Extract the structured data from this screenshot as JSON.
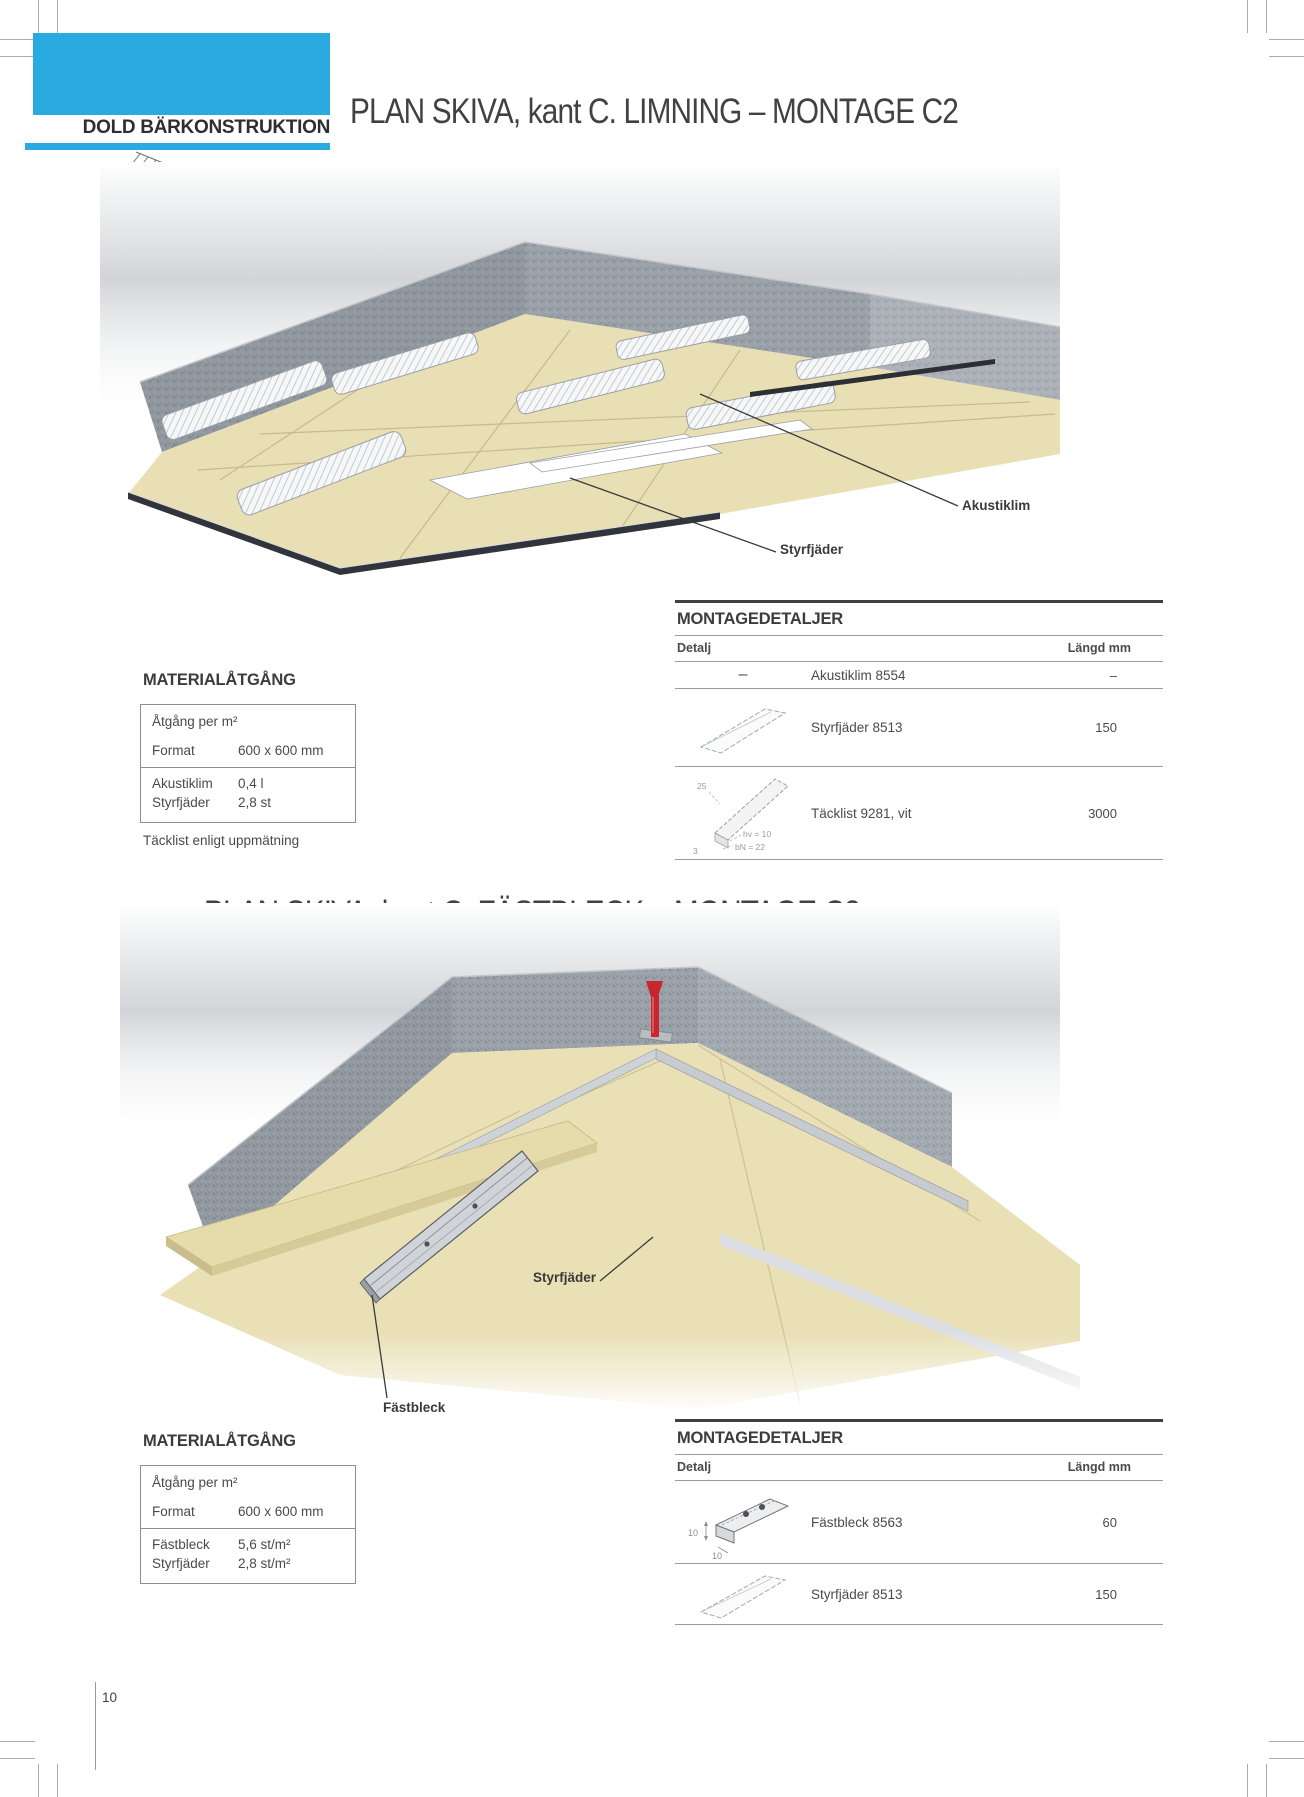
{
  "page_number": "10",
  "header": {
    "category": "DOLD BÄRKONSTRUKTION",
    "detail_ref": "C"
  },
  "sections": [
    {
      "title": "PLAN SKIVA, kant C. LIMNING –  MONTAGE C2",
      "callouts": {
        "akustiklim": "Akustiklim",
        "styrfjader": "Styrfjäder"
      },
      "material": {
        "heading": "MATERIALÅTGÅNG",
        "usage_label": "Åtgång per m²",
        "format_label": "Format",
        "format_value": "600 x 600 mm",
        "items": [
          {
            "label": "Akustiklim",
            "value": "0,4 l"
          },
          {
            "label": "Styrfjäder",
            "value": "2,8 st"
          }
        ],
        "note": "Täcklist enligt uppmätning"
      },
      "details": {
        "heading": "MONTAGEDETALJER",
        "col_detail": "Detalj",
        "col_length": "Längd mm",
        "rows": [
          {
            "marker": "–",
            "name": "Akustiklim 8554",
            "length": "–"
          },
          {
            "name": "Styrfjäder 8513",
            "length": "150"
          },
          {
            "name": "Täcklist 9281, vit",
            "length": "3000",
            "dims": {
              "d1": "25",
              "d2": "hv = 10",
              "d3": "bN = 22",
              "d4": "3"
            }
          }
        ]
      }
    },
    {
      "title": "PLAN SKIVA, kant C. FÄSTBLECK –  MONTAGE C3",
      "callouts": {
        "styrfjader": "Styrfjäder",
        "fastbleck": "Fästbleck"
      },
      "material": {
        "heading": "MATERIALÅTGÅNG",
        "usage_label": "Åtgång per m²",
        "format_label": "Format",
        "format_value": "600 x 600 mm",
        "items": [
          {
            "label": "Fästbleck",
            "value": "5,6 st/m²"
          },
          {
            "label": "Styrfjäder",
            "value": "2,8 st/m²"
          }
        ]
      },
      "details": {
        "heading": "MONTAGEDETALJER",
        "col_detail": "Detalj",
        "col_length": "Längd mm",
        "rows": [
          {
            "name": "Fästbleck 8563",
            "length": "60",
            "dims": {
              "d1": "10",
              "d2": "10"
            }
          },
          {
            "name": "Styrfjäder 8513",
            "length": "150"
          }
        ]
      }
    }
  ],
  "colors": {
    "accent_cyan": "#29abe2",
    "title_gray": "#414141",
    "rule_dark": "#404040",
    "rule_light": "#9b9b9b",
    "panel_beige": "#e8dfb4",
    "wall_gray": "#99a0a8",
    "clip_red": "#c9252d"
  }
}
